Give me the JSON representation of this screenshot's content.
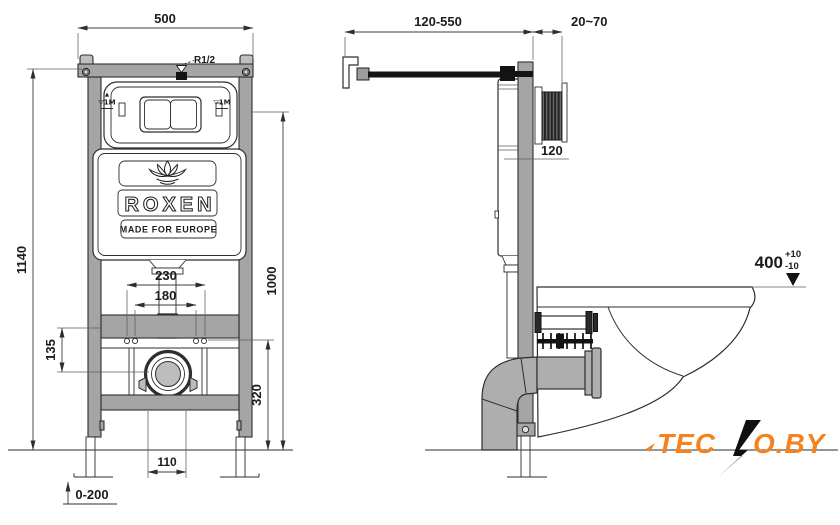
{
  "front_view": {
    "width": "500",
    "height": "1140",
    "plate_center_height": "1000",
    "hole_spacing": "230",
    "inner_spacing": "180",
    "bracket_offset": "135",
    "drain_center_height": "320",
    "drain_width": "110",
    "leg_adjustment": "0-200",
    "water_thread": "R1/2",
    "level_mark_arrow": "▲",
    "level_mark_left": "▽1M",
    "level_mark_right": "▽1M"
  },
  "side_view": {
    "hose_length": "120-550",
    "wall_distance": "20~70",
    "depth": "120",
    "bowl_height": "400",
    "bowl_height_tol_plus": "+10",
    "bowl_height_tol_minus": "-10"
  },
  "brand": {
    "name": "ROXEN",
    "tagline": "MADE FOR EUROPE"
  },
  "watermark": {
    "part1": "TEC",
    "part2": "O.BY"
  },
  "colors": {
    "accent_orange": "#f5821e",
    "frame_gray": "#a5a5a5",
    "line": "#2e2e2e"
  }
}
